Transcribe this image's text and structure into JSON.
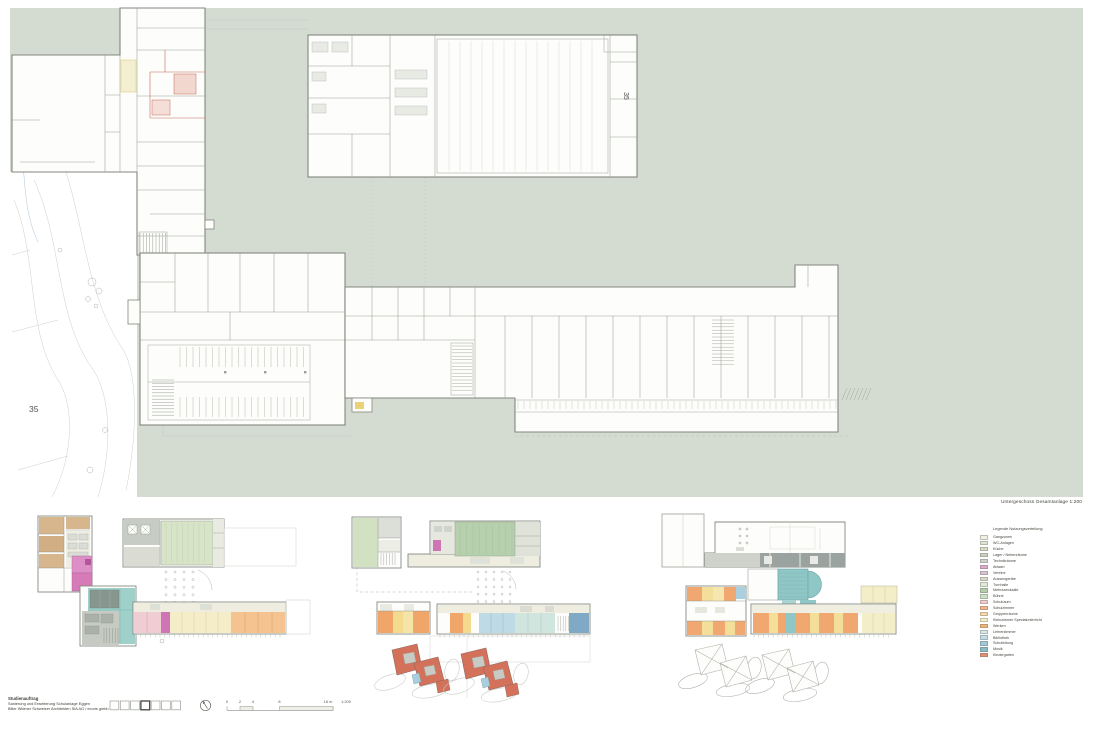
{
  "sheet": {
    "caption": "Untergeschoss Gesamtanlage 1:200",
    "background_color": "#ffffff",
    "field_color": "#d4dbd1"
  },
  "labels": {
    "building_number_site": "35",
    "building_number_hall": "35",
    "contour": "484"
  },
  "legend": {
    "title": "Legende Nutzungsverteilung",
    "items": [
      {
        "label": "Gangzonen",
        "color": "#f1efe2"
      },
      {
        "label": "WC-Anlagen",
        "color": "#e0e5d3"
      },
      {
        "label": "Küche",
        "color": "#d7dcc9"
      },
      {
        "label": "Lager / Nebenräume",
        "color": "#cbd2c1"
      },
      {
        "label": "Technikräume",
        "color": "#ced2cb"
      },
      {
        "label": "Abwart",
        "color": "#dfa9cb"
      },
      {
        "label": "Vereine",
        "color": "#d8c5d6"
      },
      {
        "label": "Aussengeräte",
        "color": "#dcd8cb"
      },
      {
        "label": "Turnhalle",
        "color": "#e2e9d5"
      },
      {
        "label": "Mehrzwecksäle",
        "color": "#b4cba7"
      },
      {
        "label": "Bühne",
        "color": "#cbdfc7"
      },
      {
        "label": "Schulraum",
        "color": "#f2cbd1"
      },
      {
        "label": "Schulzimmer",
        "color": "#f5b48a"
      },
      {
        "label": "Gruppenräume",
        "color": "#f8d9ae"
      },
      {
        "label": "Kleinzimmer Spezialunterricht",
        "color": "#f5eec9"
      },
      {
        "label": "Werken",
        "color": "#f2b377"
      },
      {
        "label": "Lehrerzimmer",
        "color": "#d8e8ee"
      },
      {
        "label": "Bibliothek",
        "color": "#c2dde8"
      },
      {
        "label": "Schulleitung",
        "color": "#a0c9d7"
      },
      {
        "label": "Musik",
        "color": "#86bbc7"
      },
      {
        "label": "Kindergarten",
        "color": "#e28f74"
      }
    ]
  },
  "title_block": {
    "line1": "Studienauftrag",
    "line2": "Sanierung und Erweiterung Schulanlage Eggen",
    "line3": "Biller Widmer Schweizer Architekten SIA AG / ecoris gmbh"
  },
  "key_plan": {
    "box_count": 7,
    "active_box": 4
  },
  "scale_bar": {
    "ticks": [
      "0",
      "2",
      "4",
      "8",
      "16 m"
    ],
    "ratio": "1:200"
  }
}
